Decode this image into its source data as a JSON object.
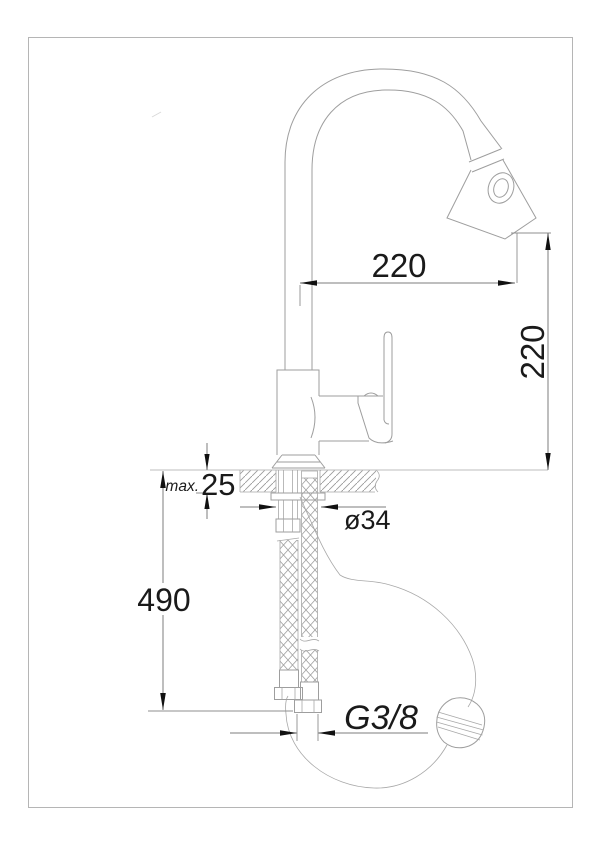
{
  "drawing": {
    "labels": {
      "spout_reach": "220",
      "spout_height": "220",
      "max_prefix": "max.",
      "deck_thickness": "25",
      "hole_diameter": "ø34",
      "hose_length": "490",
      "thread_size": "G3/8"
    },
    "colors": {
      "outline": "#9e9e9e",
      "dimension_line": "#7d7d7d",
      "text": "#1a1a1a",
      "frame": "#b5b5b5",
      "background": "#ffffff"
    }
  }
}
